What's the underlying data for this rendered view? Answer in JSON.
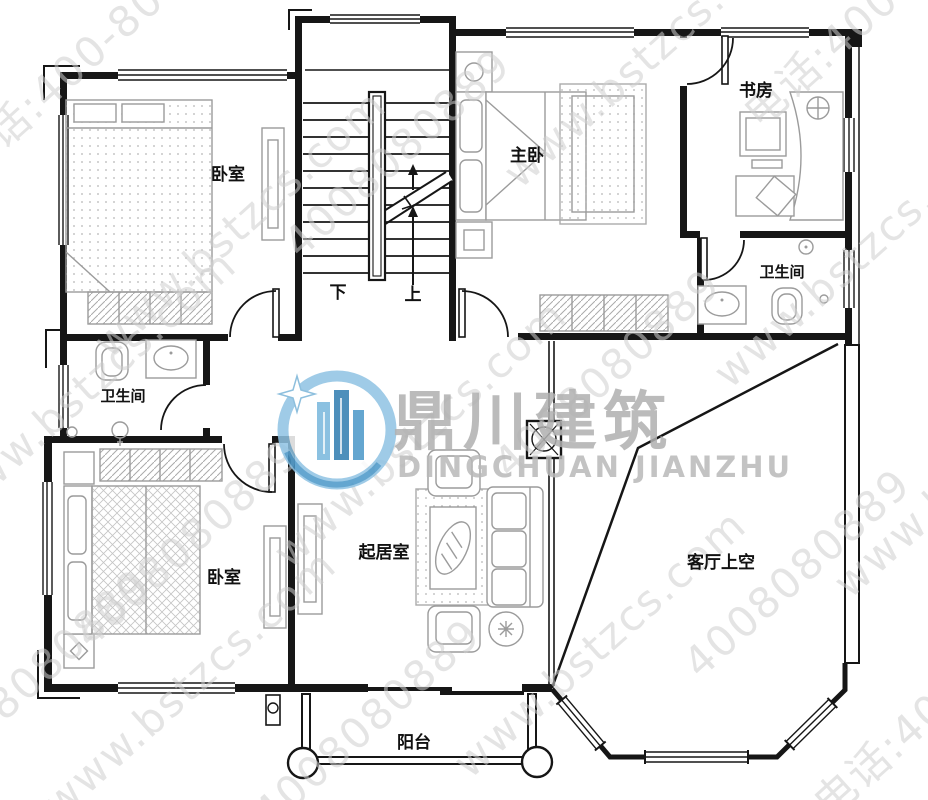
{
  "watermark": {
    "site": "www.bstzcs.com",
    "phone": "电话:400-8080-889",
    "phone_digits": "4008080889",
    "brand_cn": "鼎川建筑",
    "brand_en": "DINGCHUAN JIANZHU"
  },
  "rooms": {
    "bedroom1": "卧室",
    "master": "主卧",
    "study": "书房",
    "bath_right": "卫生间",
    "bath_left": "卫生间",
    "living": "起居室",
    "bedroom2": "卧室",
    "void": "客厅上空",
    "balcony": "阳台"
  },
  "stairs": {
    "down": "下",
    "up": "上"
  },
  "colors": {
    "wall_line": "#161616",
    "furniture_gray": "#9b9b9b",
    "watermark_gray": "#b0b0b0",
    "watermark_gray_light": "#cfcfcf",
    "logo_blue": "#4a97c8",
    "logo_blue_dark": "#2e7cb0",
    "logo_blue_light": "#b9d9ec"
  }
}
